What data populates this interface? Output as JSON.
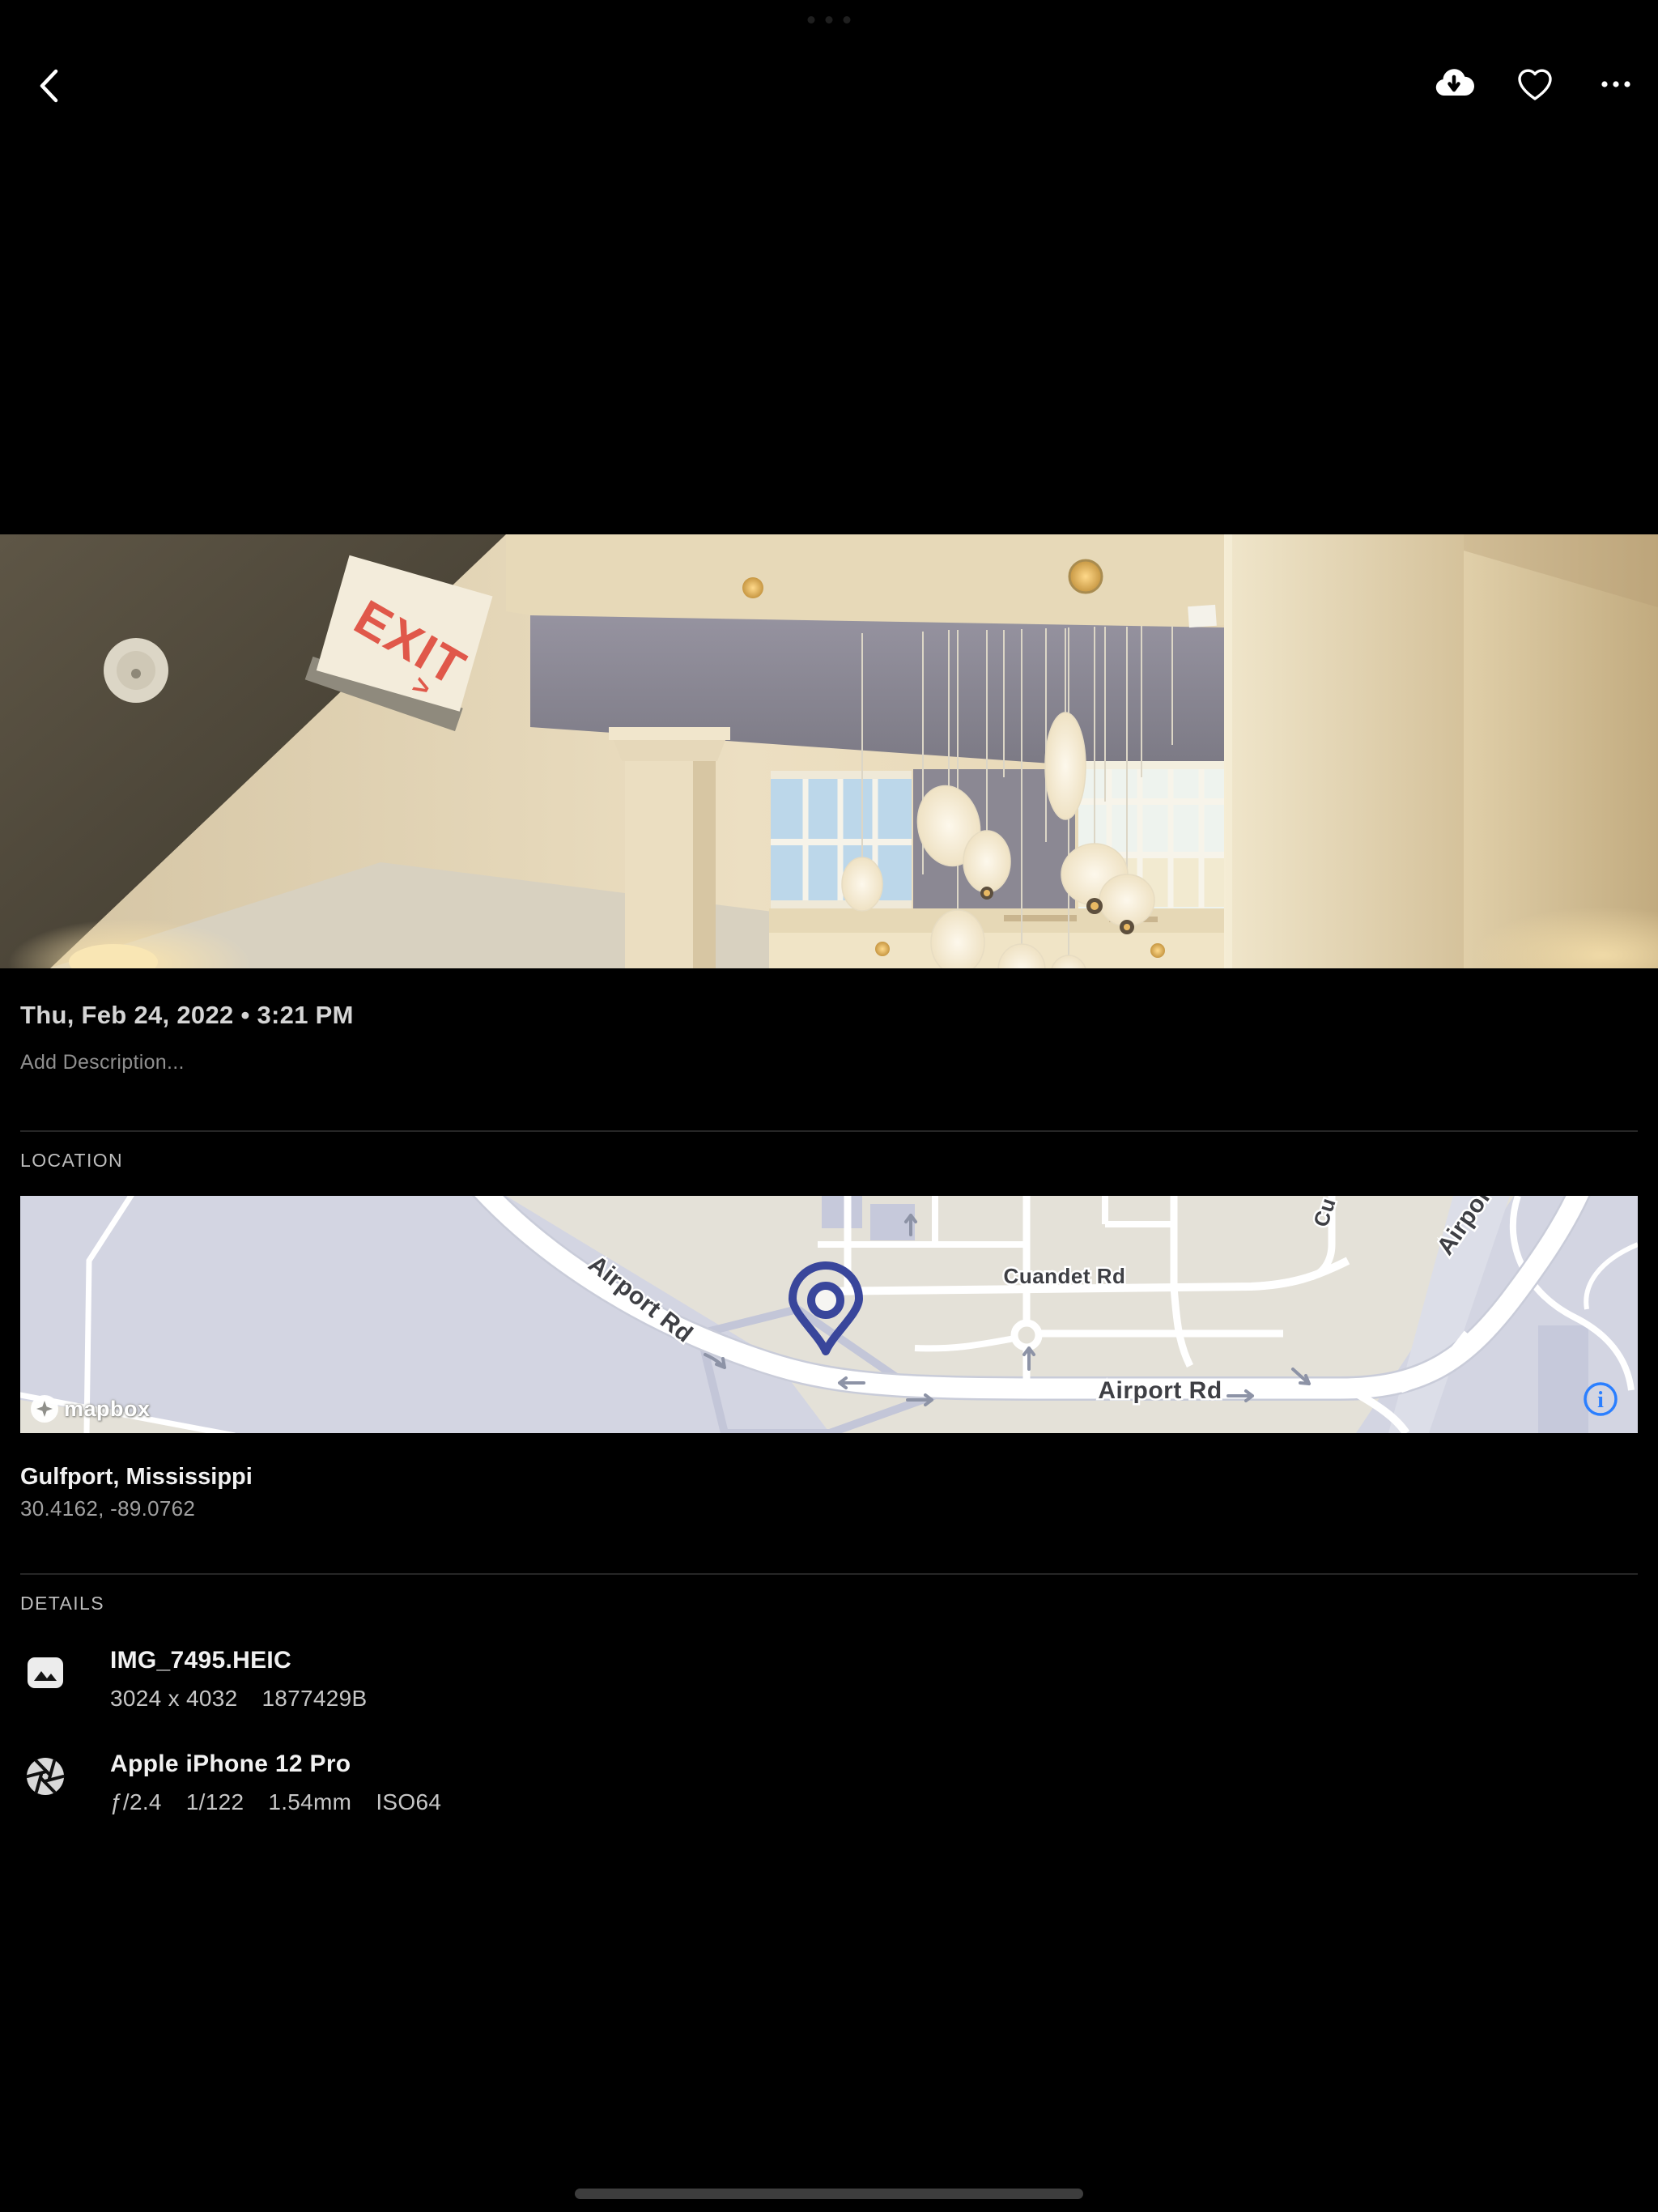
{
  "statusbar": {
    "dots_icon": "ipad-multitask-dots"
  },
  "header": {
    "back_icon": "chevron-left",
    "download_icon": "cloud-download",
    "favorite_icon": "heart-outline",
    "more_icon": "horizontal-ellipsis"
  },
  "photo": {
    "date": "Thu, Feb 24, 2022 • 3:21 PM",
    "description_placeholder": "Add Description...",
    "exit_sign": {
      "text": "EXIT",
      "arrow": ">"
    }
  },
  "location": {
    "section_label": "LOCATION",
    "place": "Gulfport, Mississippi",
    "coordinates": "30.4162, -89.0762",
    "map": {
      "attribution": "mapbox",
      "labels": {
        "airport_rd": "Airport Rd",
        "cuandet_rd": "Cuandet Rd",
        "partial_top": "Cu"
      },
      "info_icon": "i"
    }
  },
  "details": {
    "section_label": "DETAILS",
    "file": {
      "icon": "image",
      "name": "IMG_7495.HEIC",
      "dimensions": "3024 x 4032",
      "size": "1877429B"
    },
    "camera": {
      "icon": "aperture",
      "name": "Apple iPhone 12 Pro",
      "aperture": "ƒ/2.4",
      "shutter": "1/122",
      "focal_length": "1.54mm",
      "iso": "ISO64"
    }
  },
  "colors": {
    "background": "#000000",
    "accent_blue": "#2b7fff",
    "map_pin": "#39469b"
  }
}
